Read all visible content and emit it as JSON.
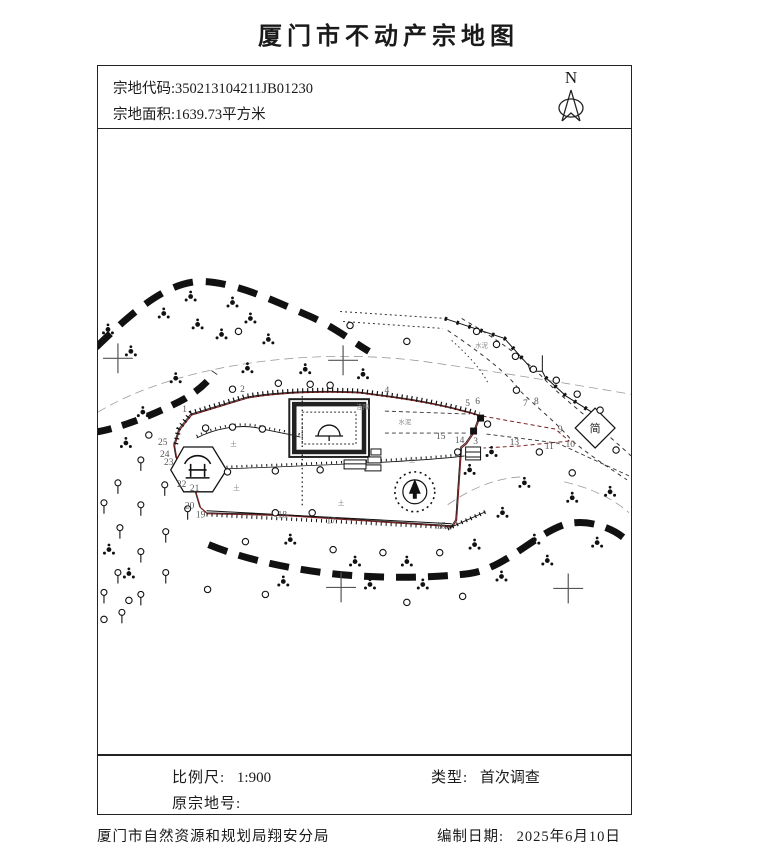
{
  "title": "厦门市不动产宗地图",
  "header": {
    "parcel_code_label": "宗地代码:",
    "parcel_code_value": "350213104211JB01230",
    "parcel_area_label": "宗地面积:",
    "parcel_area_value": "1639.73平方米",
    "north_label": "N"
  },
  "info": {
    "scale_label": "比例尺:",
    "scale_value": "1:900",
    "type_label": "类型:",
    "type_value": "首次调查",
    "original_parcel_label": "原宗地号:",
    "original_parcel_value": ""
  },
  "footer": {
    "agency": "厦门市自然资源和规划局翔安分局",
    "date_label": "编制日期:",
    "date_value": "2025年6月10日"
  },
  "map": {
    "vertex_labels": [
      {
        "n": "1",
        "x": 184,
        "y": 412
      },
      {
        "n": "2",
        "x": 242,
        "y": 392
      },
      {
        "n": "4",
        "x": 387,
        "y": 393
      },
      {
        "n": "5",
        "x": 468,
        "y": 406
      },
      {
        "n": "6",
        "x": 478,
        "y": 404
      },
      {
        "n": "7",
        "x": 526,
        "y": 406
      },
      {
        "n": "8",
        "x": 537,
        "y": 404
      },
      {
        "n": "9",
        "x": 561,
        "y": 432
      },
      {
        "n": "10",
        "x": 571,
        "y": 447
      },
      {
        "n": "11",
        "x": 550,
        "y": 449
      },
      {
        "n": "13",
        "x": 515,
        "y": 445
      },
      {
        "n": "14",
        "x": 460,
        "y": 443
      },
      {
        "n": "3",
        "x": 476,
        "y": 444
      },
      {
        "n": "15",
        "x": 441,
        "y": 439
      },
      {
        "n": "16",
        "x": 441,
        "y": 529
      },
      {
        "n": "17",
        "x": 331,
        "y": 524
      },
      {
        "n": "18",
        "x": 282,
        "y": 518
      },
      {
        "n": "19",
        "x": 200,
        "y": 518
      },
      {
        "n": "20",
        "x": 189,
        "y": 509
      },
      {
        "n": "21",
        "x": 194,
        "y": 491
      },
      {
        "n": "22",
        "x": 181,
        "y": 487
      },
      {
        "n": "23",
        "x": 168,
        "y": 465
      },
      {
        "n": "24",
        "x": 164,
        "y": 457
      },
      {
        "n": "25",
        "x": 162,
        "y": 445
      }
    ],
    "annotations": [
      {
        "t": "水泥",
        "x": 405,
        "y": 424
      },
      {
        "t": "水泥",
        "x": 482,
        "y": 347
      },
      {
        "t": "连障",
        "x": 363,
        "y": 409
      },
      {
        "t": "土",
        "x": 233,
        "y": 446
      },
      {
        "t": "土",
        "x": 236,
        "y": 490
      },
      {
        "t": "土",
        "x": 412,
        "y": 462
      },
      {
        "t": "土",
        "x": 341,
        "y": 505
      },
      {
        "t": "简",
        "x": 596,
        "y": 432,
        "c": "annot-big"
      }
    ],
    "trees": [
      [
        190,
        296
      ],
      [
        232,
        302
      ],
      [
        163,
        313
      ],
      [
        250,
        318
      ],
      [
        197,
        324
      ],
      [
        268,
        339
      ],
      [
        221,
        334
      ],
      [
        130,
        351
      ],
      [
        107,
        329
      ],
      [
        175,
        378
      ],
      [
        247,
        368
      ],
      [
        305,
        369
      ],
      [
        363,
        374
      ],
      [
        142,
        412
      ],
      [
        125,
        443
      ],
      [
        492,
        452
      ],
      [
        470,
        470
      ],
      [
        525,
        483
      ],
      [
        573,
        498
      ],
      [
        503,
        513
      ],
      [
        535,
        540
      ],
      [
        598,
        543
      ],
      [
        475,
        545
      ],
      [
        502,
        577
      ],
      [
        290,
        540
      ],
      [
        355,
        562
      ],
      [
        370,
        585
      ],
      [
        407,
        562
      ],
      [
        423,
        585
      ],
      [
        283,
        582
      ],
      [
        108,
        550
      ],
      [
        128,
        574
      ],
      [
        611,
        492
      ],
      [
        548,
        561
      ]
    ],
    "circles": [
      [
        238,
        331
      ],
      [
        350,
        325
      ],
      [
        407,
        341
      ],
      [
        232,
        389
      ],
      [
        278,
        383
      ],
      [
        310,
        384
      ],
      [
        330,
        385
      ],
      [
        148,
        435
      ],
      [
        205,
        428
      ],
      [
        232,
        427
      ],
      [
        262,
        429
      ],
      [
        275,
        513
      ],
      [
        312,
        513
      ],
      [
        245,
        542
      ],
      [
        333,
        550
      ],
      [
        383,
        553
      ],
      [
        440,
        553
      ],
      [
        207,
        590
      ],
      [
        265,
        595
      ],
      [
        407,
        603
      ],
      [
        463,
        597
      ],
      [
        128,
        601
      ],
      [
        103,
        620
      ],
      [
        477,
        331
      ],
      [
        497,
        344
      ],
      [
        516,
        356
      ],
      [
        534,
        369
      ],
      [
        557,
        380
      ],
      [
        578,
        394
      ],
      [
        601,
        410
      ],
      [
        617,
        450
      ],
      [
        458,
        452
      ],
      [
        517,
        390
      ],
      [
        540,
        452
      ],
      [
        488,
        424
      ],
      [
        227,
        472
      ],
      [
        275,
        471
      ],
      [
        320,
        470
      ],
      [
        573,
        473
      ]
    ],
    "orchard": [
      [
        140,
        465
      ],
      [
        117,
        488
      ],
      [
        164,
        490
      ],
      [
        140,
        510
      ],
      [
        103,
        508
      ],
      [
        119,
        533
      ],
      [
        165,
        537
      ],
      [
        140,
        557
      ],
      [
        117,
        578
      ],
      [
        165,
        578
      ],
      [
        140,
        600
      ],
      [
        103,
        598
      ],
      [
        187,
        514
      ],
      [
        121,
        618
      ]
    ],
    "crosses": [
      [
        117,
        358
      ],
      [
        343,
        360
      ],
      [
        341,
        588
      ],
      [
        569,
        589
      ]
    ],
    "monuments": [
      [
        481,
        418
      ],
      [
        474,
        431
      ]
    ]
  }
}
